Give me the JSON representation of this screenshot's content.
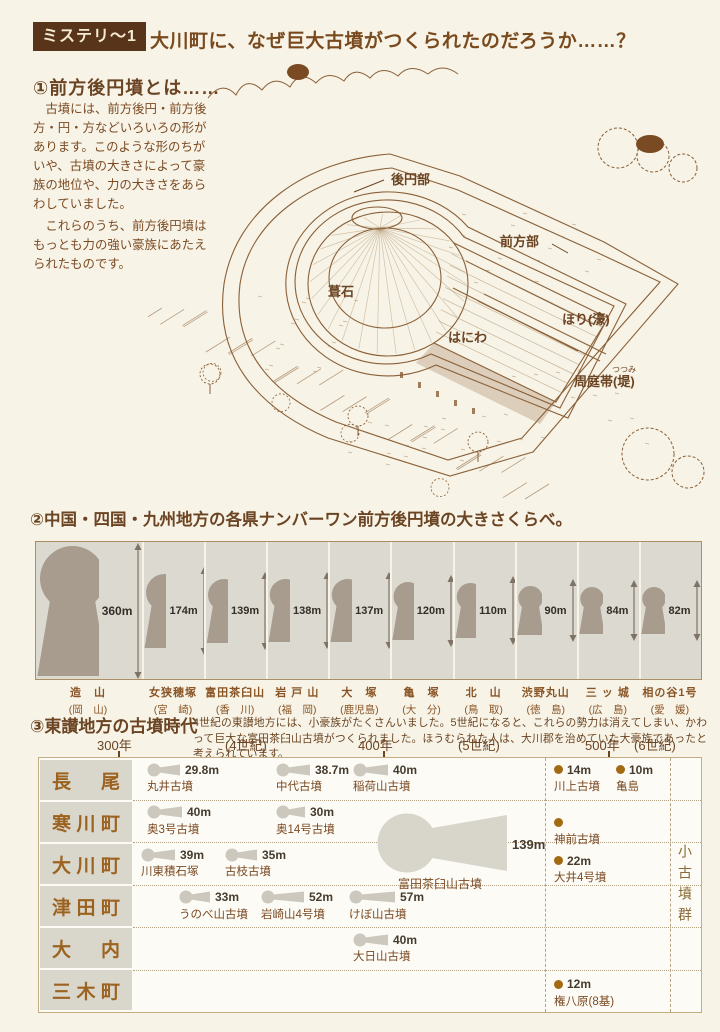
{
  "header": {
    "tag": "ミステリ〜1",
    "title": "大川町に、なぜ巨大古墳がつくられたのだろうか……？"
  },
  "section1": {
    "heading": "①前方後円墳とは……",
    "body1": "　古墳には、前方後円・前方後方・円・方などいろいろの形があります。このような形のちがいや、古墳の大きさによって豪族の地位や、力の大きさをあらわしていました。",
    "body2": "　これらのうち、前方後円墳はもっとも力の強い豪族にあたえられたものです。",
    "diagram_labels": {
      "round_part": "後円部",
      "front_part": "前方部",
      "fukiishi": "葺石",
      "haniwa": "はにわ",
      "moat": "ほり(濠)",
      "bank": "周庭帯(堤)",
      "bank_furigana": "つつみ"
    }
  },
  "section2": {
    "heading": "②中国・四国・九州地方の各県ナンバーワン前方後円墳の大きさくらべ。",
    "unit": "m",
    "tombs": [
      {
        "name": "造　山",
        "pref": "(岡　山)",
        "length_m": 360
      },
      {
        "name": "女狭穂塚",
        "pref": "(宮　崎)",
        "length_m": 174
      },
      {
        "name": "富田茶臼山",
        "pref": "(香　川)",
        "length_m": 139
      },
      {
        "name": "岩 戸 山",
        "pref": "(福　岡)",
        "length_m": 138
      },
      {
        "name": "大　塚",
        "pref": "(鹿児島)",
        "length_m": 137
      },
      {
        "name": "亀　塚",
        "pref": "(大　分)",
        "length_m": 120
      },
      {
        "name": "北　山",
        "pref": "(鳥　取)",
        "length_m": 110
      },
      {
        "name": "渋野丸山",
        "pref": "(徳　島)",
        "length_m": 90
      },
      {
        "name": "三 ッ 城",
        "pref": "(広　島)",
        "length_m": 84
      },
      {
        "name": "相の谷1号",
        "pref": "(愛　媛)",
        "length_m": 82
      }
    ]
  },
  "section3": {
    "heading": "③東讃地方の古墳時代",
    "intro": "4世紀の東讃地方には、小豪族がたくさんいました。5世紀になると、これらの勢力は消えてしまい、かわって巨大な富田茶臼山古墳がつくられました。ほうむられた人は、大川郡を治めていた大豪族であったと考えられています。",
    "scale": [
      {
        "label": "300年",
        "x": 97,
        "tick": 118
      },
      {
        "label": "(4世紀)",
        "x": 225
      },
      {
        "label": "400年",
        "x": 358,
        "tick": 383
      },
      {
        "label": "(5世紀)",
        "x": 458
      },
      {
        "label": "500年",
        "x": 585,
        "tick": 608
      },
      {
        "label": "(6世紀)",
        "x": 634
      }
    ],
    "rows": [
      {
        "town": "長尾",
        "entries": [
          {
            "kind": "keyhole",
            "size": "29.8m",
            "name": "丸井古墳",
            "x": 14,
            "w": 34
          },
          {
            "kind": "keyhole",
            "size": "38.7m",
            "name": "中代古墳",
            "x": 143,
            "w": 35
          },
          {
            "kind": "keyhole",
            "size": "40m",
            "name": "稲荷山古墳",
            "x": 220,
            "w": 36
          },
          {
            "kind": "dot",
            "size": "14m",
            "name": "川上古墳",
            "x": 421
          },
          {
            "kind": "dot",
            "size": "10m",
            "name": "亀島",
            "x": 483
          }
        ]
      },
      {
        "town": "寒川町",
        "entries": [
          {
            "kind": "keyhole",
            "size": "40m",
            "name": "奥3号古墳",
            "x": 14,
            "w": 36
          },
          {
            "kind": "keyhole",
            "size": "30m",
            "name": "奥14号古墳",
            "x": 143,
            "w": 30
          },
          {
            "kind": "dot",
            "size": "",
            "name": "神前古墳",
            "x": 421,
            "top": 14
          }
        ]
      },
      {
        "town": "大川町",
        "entries": [
          {
            "kind": "keyhole",
            "size": "39m",
            "name": "川東積石塚",
            "x": 8,
            "w": 35
          },
          {
            "kind": "keyhole",
            "size": "35m",
            "name": "古枝古墳",
            "x": 92,
            "w": 33
          },
          {
            "kind": "dot",
            "size": "22m",
            "name": "大井4号墳",
            "x": 421,
            "top": 10
          }
        ]
      },
      {
        "town": "津田町",
        "entries": [
          {
            "kind": "keyhole",
            "size": "33m",
            "name": "うのべ山古墳",
            "x": 46,
            "w": 32
          },
          {
            "kind": "keyhole",
            "size": "52m",
            "name": "岩崎山4号墳",
            "x": 128,
            "w": 44
          },
          {
            "kind": "keyhole",
            "size": "57m",
            "name": "けぼ山古墳",
            "x": 216,
            "w": 47
          }
        ]
      },
      {
        "town": "大内",
        "entries": [
          {
            "kind": "keyhole",
            "size": "40m",
            "name": "大日山古墳",
            "x": 220,
            "w": 36
          }
        ]
      },
      {
        "town": "三木町",
        "entries": [
          {
            "kind": "dot",
            "size": "12m",
            "name": "権八原(8基)",
            "x": 421,
            "top": 6
          }
        ]
      }
    ],
    "big_tomb": {
      "size": "139m",
      "name": "富田茶臼山古墳"
    },
    "small_group_label": "小古墳群"
  },
  "chart_data": [
    {
      "type": "bar",
      "title": "中国・四国・九州地方の各県ナンバーワン前方後円墳の大きさくらべ",
      "categories": [
        "造山(岡山)",
        "女狭穂塚(宮崎)",
        "富田茶臼山(香川)",
        "岩戸山(福岡)",
        "大塚(鹿児島)",
        "亀塚(大分)",
        "北山(鳥取)",
        "渋野丸山(徳島)",
        "三ッ城(広島)",
        "相の谷1号(愛媛)"
      ],
      "values": [
        360,
        174,
        139,
        138,
        137,
        120,
        110,
        90,
        84,
        82
      ],
      "unit": "m",
      "ylabel": "墳丘長"
    },
    {
      "type": "table",
      "title": "東讃地方の古墳時代",
      "x_axis": [
        "300年",
        "(4世紀)",
        "400年",
        "(5世紀)",
        "500年",
        "(6世紀)"
      ],
      "rows": [
        {
          "area": "長尾",
          "tombs": [
            "丸井古墳 29.8m",
            "中代古墳 38.7m",
            "稲荷山古墳 40m",
            "川上古墳 14m",
            "亀島 10m"
          ]
        },
        {
          "area": "寒川町",
          "tombs": [
            "奥3号古墳 40m",
            "奥14号古墳 30m",
            "神前古墳"
          ]
        },
        {
          "area": "大川町",
          "tombs": [
            "川東積石塚 39m",
            "古枝古墳 35m",
            "富田茶臼山古墳 139m",
            "大井4号墳 22m"
          ]
        },
        {
          "area": "津田町",
          "tombs": [
            "うのべ山古墳 33m",
            "岩崎山4号墳 52m",
            "けぼ山古墳 57m"
          ]
        },
        {
          "area": "大内",
          "tombs": [
            "大日山古墳 40m"
          ]
        },
        {
          "area": "三木町",
          "tombs": [
            "権八原(8基) 12m"
          ]
        }
      ]
    }
  ]
}
